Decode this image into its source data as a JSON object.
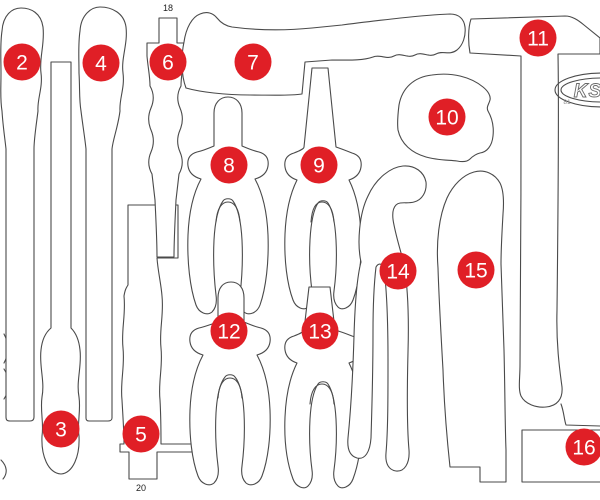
{
  "colors": {
    "accent": "#e01f26",
    "outline": "#4a4a4a",
    "label": "#222222",
    "brand": "#8a8a8a"
  },
  "diagram": {
    "slot_label_top": "18",
    "slot_label_bottom": "20"
  },
  "brand": {
    "logo_text": "KS",
    "code_text": "81"
  },
  "markers": [
    {
      "label": "2"
    },
    {
      "label": "3"
    },
    {
      "label": "4"
    },
    {
      "label": "5"
    },
    {
      "label": "6"
    },
    {
      "label": "7"
    },
    {
      "label": "8"
    },
    {
      "label": "9"
    },
    {
      "label": "10"
    },
    {
      "label": "11"
    },
    {
      "label": "12"
    },
    {
      "label": "13"
    },
    {
      "label": "14"
    },
    {
      "label": "15"
    },
    {
      "label": "16"
    }
  ]
}
